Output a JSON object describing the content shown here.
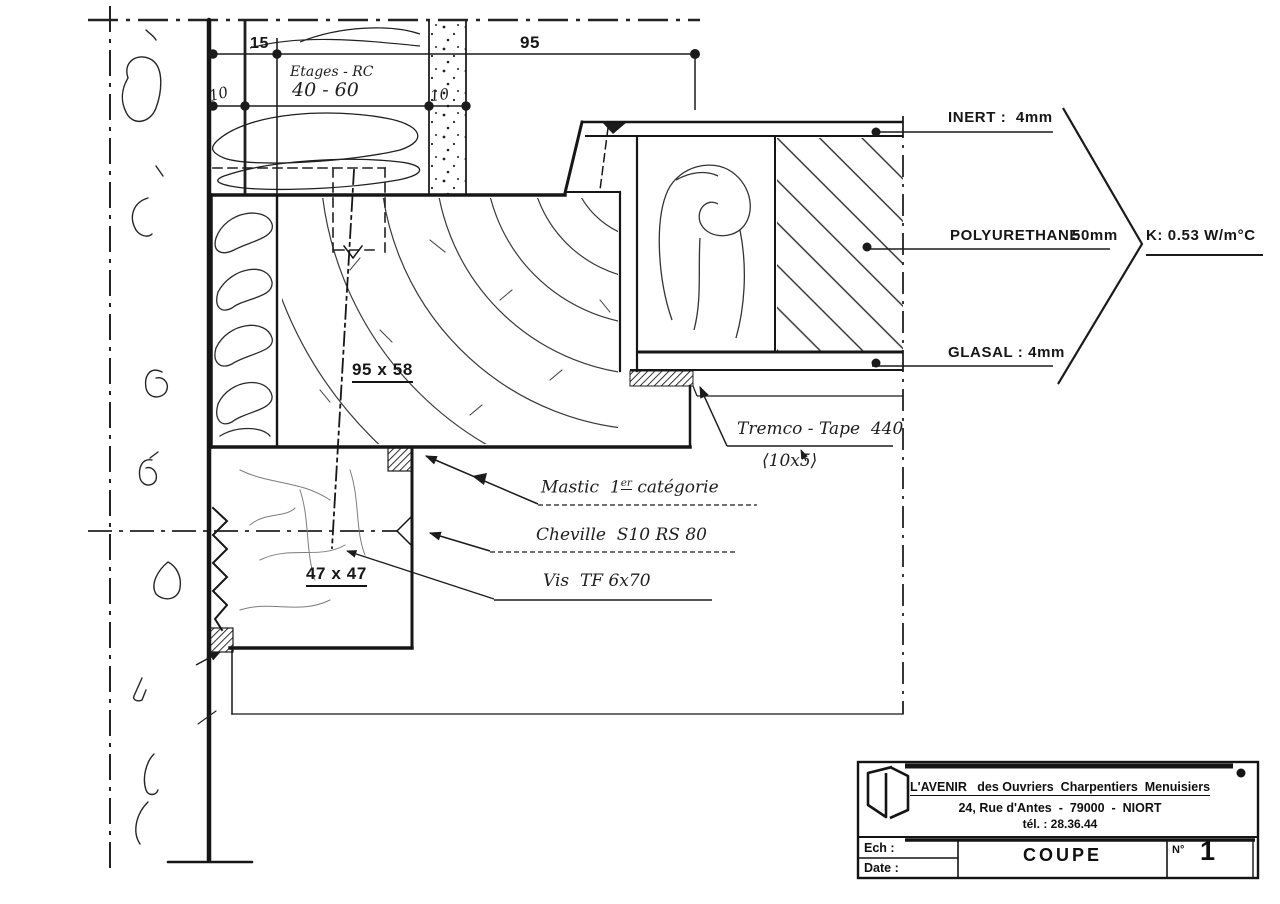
{
  "meta": {
    "paper": "#ffffff",
    "ink": "#1b1b1b"
  },
  "dimensions": {
    "d15": "15",
    "d95": "95",
    "d10_left": "10",
    "d10_right": "10",
    "floors_note": "Etages - RC",
    "floors_range": "40 - 60",
    "sash_section": "95 x 58",
    "batten_section": "47 x 47"
  },
  "materials": {
    "inert": "INERT :  4mm",
    "polyurethane": "POLYURETHANE",
    "polyurethane_size": "50mm",
    "k_value": "K: 0.53 W/m°C",
    "glasal": "GLASAL : 4mm",
    "tremco": "Tremco - Tape  440",
    "tremco_size": "⟨10x5⟩",
    "mastic_pre": "Mastic  1",
    "mastic_sup": "er",
    "mastic_post": " catégorie",
    "cheville": "Cheville  S10 RS 80",
    "vis": "Vis  TF 6x70"
  },
  "title_block": {
    "company": "L'AVENIR   des Ouvriers  Charpentiers  Menuisiers",
    "address": "24, Rue d'Antes  -  79000  -  NIORT",
    "phone": "tél. : 28.36.44",
    "scale_label": "Ech :",
    "date_label": "Date :",
    "drawing_title": "COUPE",
    "number_label": "N°",
    "number_value": "1"
  }
}
